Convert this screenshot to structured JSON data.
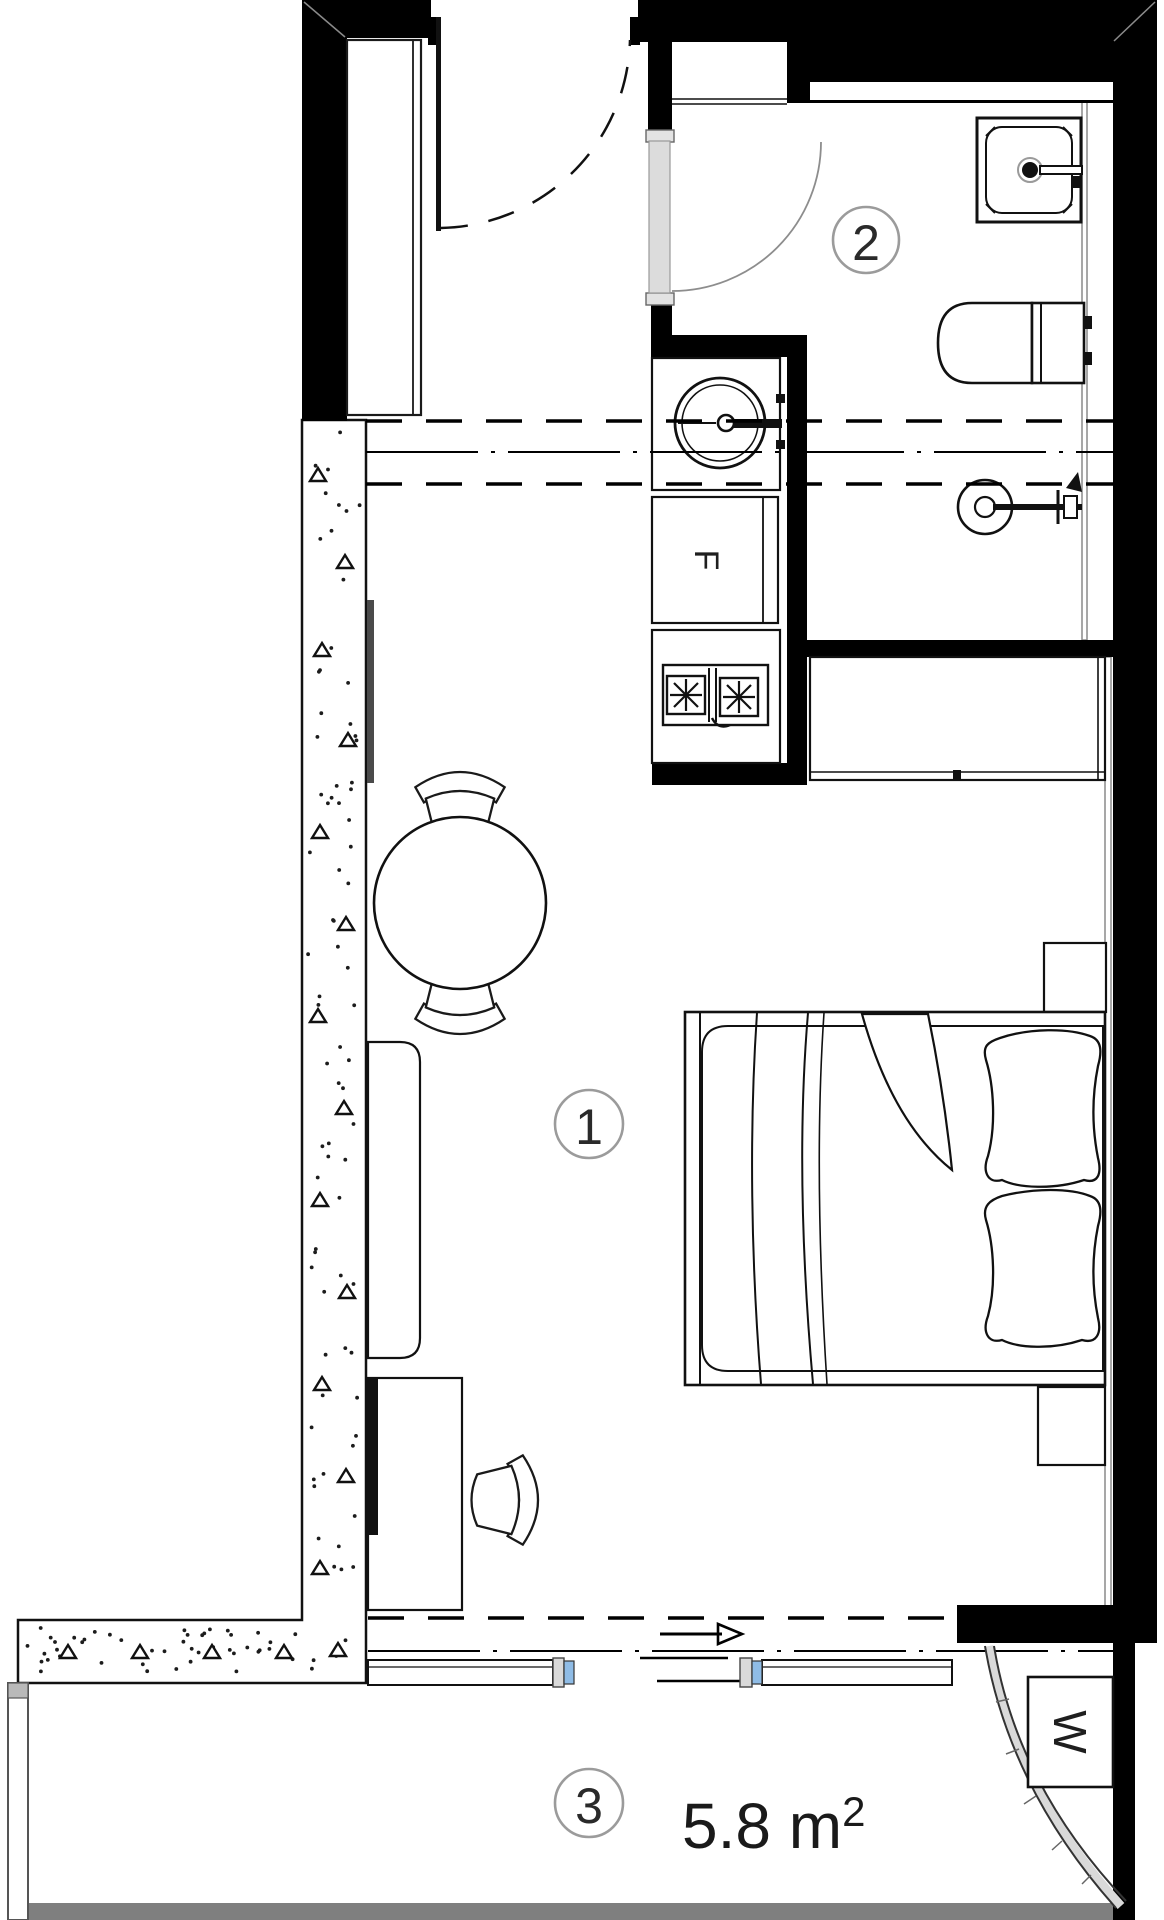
{
  "plan": {
    "title": "studio-apartment-floor-plan",
    "rooms": [
      {
        "number": "1",
        "type": "main-room"
      },
      {
        "number": "2",
        "type": "bathroom"
      },
      {
        "number": "3",
        "type": "balcony",
        "area_value": "5.8 m",
        "area_sup": "2",
        "area": "5.8 m²"
      }
    ],
    "appliance_labels": {
      "fridge": "F",
      "washer": "W"
    },
    "colors": {
      "wall": "#000000",
      "line": "#111111",
      "label_circle": "#9b9b9b",
      "glazing_blue": "#8fbce6",
      "door_leaf_gray": "#dcdcdc",
      "sill_gray": "#e3e3e3",
      "floor_gray": "#7f7f7f",
      "face_gray": "#8a8a8a",
      "text": "#1f1f1f"
    }
  }
}
